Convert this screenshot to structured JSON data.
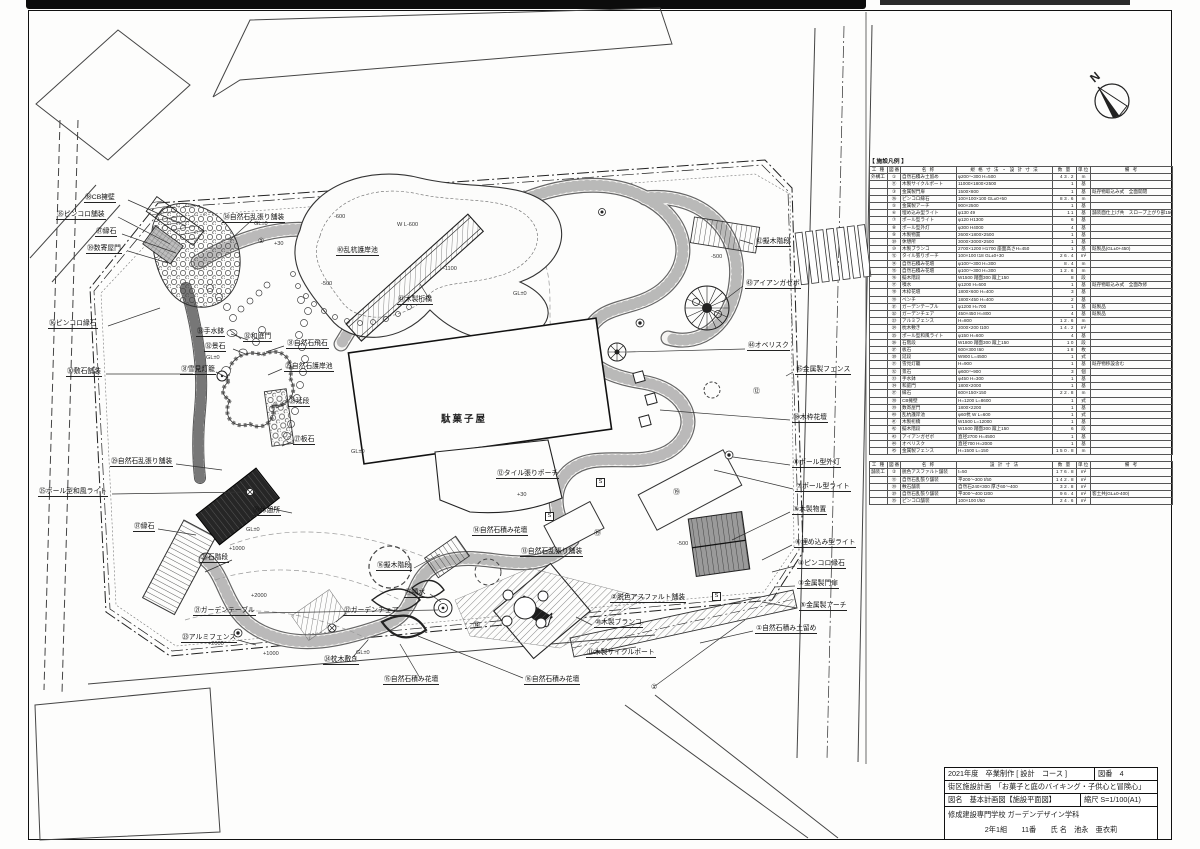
{
  "sheet": {
    "building_label": "駄菓子屋",
    "north_label": "N"
  },
  "labels": [
    {
      "x": 84,
      "y": 194,
      "t": "㊳CB擁壁",
      "c": ""
    },
    {
      "x": 56,
      "y": 211,
      "t": "㉟ピンコロ舗装",
      "c": ""
    },
    {
      "x": 95,
      "y": 228,
      "t": "㊲縁石",
      "c": ""
    },
    {
      "x": 86,
      "y": 245,
      "t": "㊴数寄屋門",
      "c": ""
    },
    {
      "x": 48,
      "y": 320,
      "t": "㊱ピンコロ縁石",
      "c": ""
    },
    {
      "x": 66,
      "y": 368,
      "t": "㉚敷石舗装",
      "c": ""
    },
    {
      "x": 110,
      "y": 458,
      "t": "㉙自然石乱張り舗装",
      "c": ""
    },
    {
      "x": 38,
      "y": 488,
      "t": "㉕ポール型和風ライト",
      "c": ""
    },
    {
      "x": 133,
      "y": 523,
      "t": "㊲縁石",
      "c": ""
    },
    {
      "x": 200,
      "y": 554,
      "t": "㉖石階段",
      "c": ""
    },
    {
      "x": 193,
      "y": 607,
      "t": "㉑ガーデンテーブル",
      "c": ""
    },
    {
      "x": 181,
      "y": 634,
      "t": "㉓アルミフェンス",
      "c": ""
    },
    {
      "x": 343,
      "y": 607,
      "t": "㉒ガーデンチェア",
      "c": ""
    },
    {
      "x": 323,
      "y": 656,
      "t": "㉔枕木敷き",
      "c": ""
    },
    {
      "x": 383,
      "y": 676,
      "t": "⑮自然石積み花壇",
      "c": ""
    },
    {
      "x": 524,
      "y": 676,
      "t": "⑯自然石積み花壇",
      "c": ""
    },
    {
      "x": 196,
      "y": 328,
      "t": "㉝手水鉢",
      "c": ""
    },
    {
      "x": 204,
      "y": 343,
      "t": "㉜景石",
      "c": ""
    },
    {
      "x": 180,
      "y": 366,
      "t": "㉛雪見灯籠",
      "c": ""
    },
    {
      "x": 286,
      "y": 340,
      "t": "㉛自然石飛石",
      "c": ""
    },
    {
      "x": 284,
      "y": 363,
      "t": "㉙自然石護岸池",
      "c": ""
    },
    {
      "x": 288,
      "y": 398,
      "t": "㉘延段",
      "c": ""
    },
    {
      "x": 293,
      "y": 436,
      "t": "㉗板石",
      "c": ""
    },
    {
      "x": 243,
      "y": 333,
      "t": "㉜和庭門",
      "c": ""
    },
    {
      "x": 222,
      "y": 214,
      "t": "㉞自然石乱張り舗装",
      "c": ""
    },
    {
      "x": 336,
      "y": 247,
      "t": "㊵乱杭護岸池",
      "c": ""
    },
    {
      "x": 397,
      "y": 296,
      "t": "㊶木製桁橋",
      "c": ""
    },
    {
      "x": 755,
      "y": 238,
      "t": "㊷擬木階段",
      "c": ""
    },
    {
      "x": 745,
      "y": 280,
      "t": "㊸アイアンガゼボ",
      "c": ""
    },
    {
      "x": 747,
      "y": 342,
      "t": "㊹オベリスク",
      "c": ""
    },
    {
      "x": 795,
      "y": 366,
      "t": "㊺金属製フェンス",
      "c": ""
    },
    {
      "x": 792,
      "y": 414,
      "t": "⑱木枠花壇",
      "c": ""
    },
    {
      "x": 792,
      "y": 459,
      "t": "⑧ポール型外灯",
      "c": ""
    },
    {
      "x": 795,
      "y": 483,
      "t": "⑦ポール型ライト",
      "c": ""
    },
    {
      "x": 792,
      "y": 506,
      "t": "⑨木製物置",
      "c": ""
    },
    {
      "x": 794,
      "y": 539,
      "t": "⑥埋め込み型ライト",
      "c": ""
    },
    {
      "x": 797,
      "y": 560,
      "t": "④ピンコロ縁石",
      "c": ""
    },
    {
      "x": 797,
      "y": 580,
      "t": "③金属製門扉",
      "c": ""
    },
    {
      "x": 799,
      "y": 602,
      "t": "⑤金属製アーチ",
      "c": ""
    },
    {
      "x": 755,
      "y": 625,
      "t": "①自然石積み土留め",
      "c": ""
    },
    {
      "x": 610,
      "y": 594,
      "t": "②脱色アスファルト舗装",
      "c": ""
    },
    {
      "x": 594,
      "y": 619,
      "t": "⑩木製ブランコ",
      "c": ""
    },
    {
      "x": 586,
      "y": 649,
      "t": "⑪木製サイクルポート",
      "c": ""
    },
    {
      "x": 496,
      "y": 470,
      "t": "⑫タイル張りポーチ",
      "c": ""
    },
    {
      "x": 472,
      "y": 527,
      "t": "⑭自然石積み花壇",
      "c": ""
    },
    {
      "x": 520,
      "y": 548,
      "t": "⑬自然石乱張り舗装",
      "c": ""
    },
    {
      "x": 252,
      "y": 507,
      "t": "⑳休憩所",
      "c": ""
    },
    {
      "x": 376,
      "y": 562,
      "t": "⑯擬木階段",
      "c": ""
    },
    {
      "x": 404,
      "y": 589,
      "t": "⑰噴水",
      "c": ""
    },
    {
      "x": 440,
      "y": 416,
      "t": "駄菓子屋",
      "c": "big"
    },
    {
      "x": 257,
      "y": 238,
      "t": "①",
      "c": "circ"
    },
    {
      "x": 472,
      "y": 622,
      "t": "⑭",
      "c": "circ"
    },
    {
      "x": 650,
      "y": 684,
      "t": "①",
      "c": "circ"
    },
    {
      "x": 752,
      "y": 388,
      "t": "⑫",
      "c": "circ"
    },
    {
      "x": 593,
      "y": 530,
      "t": "⑲",
      "c": "circ"
    },
    {
      "x": 672,
      "y": 489,
      "t": "⑲",
      "c": "circ"
    },
    {
      "x": 253,
      "y": 221,
      "t": "GL±0",
      "c": "ann"
    },
    {
      "x": 512,
      "y": 291,
      "t": "GL±0",
      "c": "ann"
    },
    {
      "x": 350,
      "y": 449,
      "t": "GL±0",
      "c": "ann"
    },
    {
      "x": 245,
      "y": 527,
      "t": "GL±0",
      "c": "ann"
    },
    {
      "x": 355,
      "y": 650,
      "t": "GL±0",
      "c": "ann"
    },
    {
      "x": 205,
      "y": 355,
      "t": "GL±0",
      "c": "ann"
    },
    {
      "x": 273,
      "y": 241,
      "t": "+30",
      "c": "ann"
    },
    {
      "x": 516,
      "y": 492,
      "t": "+30",
      "c": "ann"
    },
    {
      "x": 228,
      "y": 546,
      "t": "+1000",
      "c": "ann"
    },
    {
      "x": 262,
      "y": 651,
      "t": "+1000",
      "c": "ann"
    },
    {
      "x": 250,
      "y": 593,
      "t": "+2000",
      "c": "ann"
    },
    {
      "x": 207,
      "y": 641,
      "t": "+2000",
      "c": "ann"
    },
    {
      "x": 320,
      "y": 281,
      "t": "-500",
      "c": "ann"
    },
    {
      "x": 710,
      "y": 254,
      "t": "-500",
      "c": "ann"
    },
    {
      "x": 676,
      "y": 541,
      "t": "-500",
      "c": "ann"
    },
    {
      "x": 333,
      "y": 214,
      "t": "-600",
      "c": "ann"
    },
    {
      "x": 442,
      "y": 266,
      "t": "-1100",
      "c": "ann"
    },
    {
      "x": 396,
      "y": 222,
      "t": "W L-600",
      "c": "ann"
    },
    {
      "x": 596,
      "y": 478,
      "t": "S",
      "c": "sbox"
    },
    {
      "x": 545,
      "y": 512,
      "t": "S",
      "c": "sbox"
    },
    {
      "x": 712,
      "y": 592,
      "t": "S",
      "c": "sbox"
    }
  ],
  "table": {
    "caption": "【 施設凡例 】",
    "headers": [
      "工 種",
      "図番",
      "名 称",
      "規 格 寸 法 ・ 設 計 寸 法",
      "数 量",
      "単位",
      "備 考"
    ],
    "sections": [
      {
        "rows": [
          [
            "外構工",
            "①",
            "自然石積み土留め",
            "φ200〜300 H=500",
            "43.2",
            "m",
            ""
          ],
          [
            "",
            "⑪",
            "木製サイクルポート",
            "11000×1800×2500",
            "1",
            "基",
            ""
          ],
          [
            "",
            "③",
            "金属製門扉",
            "1500×800",
            "1",
            "基",
            "既存物取込み式　全面開閉"
          ],
          [
            "",
            "㊱",
            "ピンコロ縁石",
            "100×100×100 GL±0+50",
            "83.6",
            "m",
            ""
          ],
          [
            "",
            "⑤",
            "金属製アーチ",
            "900×2500",
            "1",
            "基",
            ""
          ],
          [
            "",
            "⑥",
            "埋め込み型ライト",
            "φ130 49",
            "11",
            "基",
            "舗装面仕上げ共　スロープ上がり部150×120"
          ],
          [
            "",
            "⑦",
            "ポール型ライト",
            "φ120 H1300",
            "6",
            "基",
            ""
          ],
          [
            "",
            "⑧",
            "ポール型外灯",
            "φ300 H4000",
            "4",
            "基",
            ""
          ],
          [
            "",
            "⑨",
            "木製物置",
            "2600×1800×2500",
            "1",
            "基",
            ""
          ],
          [
            "",
            "⑳",
            "休憩所",
            "3000×3000×2500",
            "1",
            "基",
            ""
          ],
          [
            "",
            "⑩",
            "木製ブランコ",
            "2700×1200 H1700 座面高さH=450",
            "1",
            "基",
            "既製品(GL±0+450)"
          ],
          [
            "",
            "⑫",
            "タイル張りポーチ",
            "100×100 t18 GL±0+30",
            "26.4",
            "m²",
            ""
          ],
          [
            "",
            "⑭",
            "自然石積み花壇",
            "φ100〜300 H=300",
            "8.4",
            "m",
            ""
          ],
          [
            "",
            "⑮",
            "自然石積み花壇",
            "φ100〜300 H=300",
            "12.6",
            "m",
            ""
          ],
          [
            "",
            "⑯",
            "擬木階段",
            "W1500 踏面300 蹴上150",
            "8",
            "段",
            ""
          ],
          [
            "",
            "⑰",
            "噴水",
            "φ1200 H=600",
            "1",
            "基",
            "既存物取込み式　全面改修"
          ],
          [
            "",
            "⑱",
            "木枠花壇",
            "1800×600 H=400",
            "3",
            "基",
            ""
          ],
          [
            "",
            "⑲",
            "ベンチ",
            "1800×450 H=400",
            "2",
            "基",
            ""
          ],
          [
            "",
            "㉑",
            "ガーデンテーブル",
            "φ1200 H=700",
            "1",
            "基",
            "既製品"
          ],
          [
            "",
            "㉒",
            "ガーデンチェア",
            "450×450 H=800",
            "4",
            "基",
            "既製品"
          ],
          [
            "",
            "㉓",
            "アルミフェンス",
            "H=800",
            "12.6",
            "m",
            ""
          ],
          [
            "",
            "㉔",
            "枕木敷き",
            "2000×200 t100",
            "14.2",
            "m²",
            ""
          ],
          [
            "",
            "㉕",
            "ポール型和風ライト",
            "φ150 H=600",
            "4",
            "基",
            ""
          ],
          [
            "",
            "㉖",
            "石階段",
            "W1800 踏面300 蹴上150",
            "10",
            "段",
            ""
          ],
          [
            "",
            "㉗",
            "板石",
            "600×300 t60",
            "18",
            "枚",
            ""
          ],
          [
            "",
            "㉘",
            "延段",
            "W900 L=4500",
            "1",
            "式",
            ""
          ],
          [
            "",
            "㉛",
            "雪見灯籠",
            "H=900",
            "1",
            "基",
            "既存物移設含む"
          ],
          [
            "",
            "㉜",
            "景石",
            "φ600〜900",
            "3",
            "個",
            ""
          ],
          [
            "",
            "㉝",
            "手水鉢",
            "φ450 H=300",
            "1",
            "基",
            ""
          ],
          [
            "",
            "㉞",
            "和庭門",
            "1800×2000",
            "1",
            "基",
            ""
          ],
          [
            "",
            "㊲",
            "縁石",
            "600×150×150",
            "22.8",
            "m",
            ""
          ],
          [
            "",
            "㊳",
            "CB擁壁",
            "H=1200 L=8600",
            "1",
            "式",
            ""
          ],
          [
            "",
            "㊴",
            "数寄屋門",
            "1800×2200",
            "1",
            "基",
            ""
          ],
          [
            "",
            "㊵",
            "乱杭護岸池",
            "φ60杭 W L=600",
            "1",
            "式",
            ""
          ],
          [
            "",
            "㊶",
            "木製桁橋",
            "W1500 L=12000",
            "1",
            "基",
            ""
          ],
          [
            "",
            "㊷",
            "擬木階段",
            "W1500 踏面300 蹴上150",
            "6",
            "段",
            ""
          ],
          [
            "",
            "㊸",
            "アイアンガゼボ",
            "直径2700 H=4500",
            "1",
            "基",
            ""
          ],
          [
            "",
            "㊹",
            "オベリスク",
            "直径700 H=2000",
            "1",
            "基",
            ""
          ],
          [
            "",
            "㊺",
            "金属製フェンス",
            "H=1500 L=150",
            "150.8",
            "m",
            ""
          ]
        ]
      },
      {
        "headers": [
          "工 種",
          "図番",
          "名 称",
          "設 計 寸 法",
          "数 量",
          "単位",
          "備 考"
        ],
        "rows": [
          [
            "舗装工",
            "②",
            "脱色アスファルト舗装",
            "t=50",
            "176.8",
            "m²",
            ""
          ],
          [
            "",
            "⑬",
            "自然石乱張り舗装",
            "平200〜300 t/50",
            "142.8",
            "m²",
            ""
          ],
          [
            "",
            "㉚",
            "敷石舗装",
            "自然石240×300 厚さ60〜400",
            "32.8",
            "m²",
            ""
          ],
          [
            "",
            "㉙",
            "自然石乱張り舗装",
            "平300〜400 t200",
            "96.4",
            "m²",
            "客土共(GL±0-400)"
          ],
          [
            "",
            "㉟",
            "ピンコロ舗装",
            "100×100 t/50",
            "24.6",
            "m²",
            ""
          ]
        ]
      }
    ]
  },
  "title_block": {
    "r1_left": "2021年度　卒業制作 [ 設計　コース ]",
    "r1_right": "図番　4",
    "r2": "街区施設計画　「お菓子と庭のバイキング・子供心と冒険心」",
    "r3_left": "図名　基本計画図【施設平面図】",
    "r3_right": "縮尺 S=1/100(A1)",
    "r4_line1": "修成建設専門学校 ガーデンデザイン学科",
    "r4_line2": "2年1組　　11番　　氏 名　池永　亜衣莉"
  }
}
